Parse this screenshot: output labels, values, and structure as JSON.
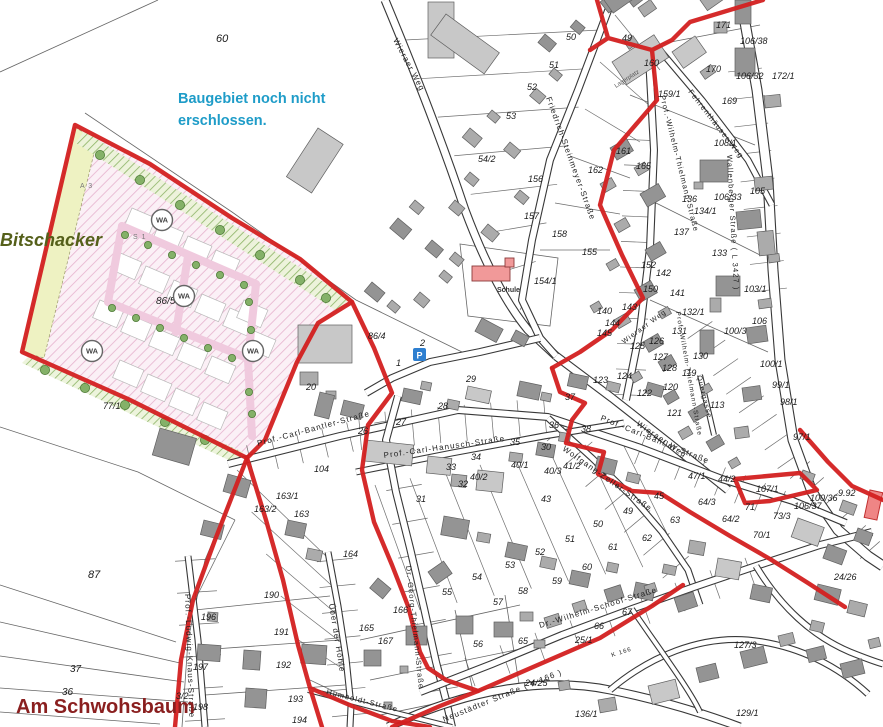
{
  "annotations": {
    "development_note_line1": "Baugebiet noch nicht",
    "development_note_line2": "erschlossen.",
    "area_name_west": "Bitschacker",
    "area_name_south": "Am Schwohsbaum"
  },
  "colors": {
    "note_blue": "#1e9cc8",
    "bitschacker_green": "#55601a",
    "schwohsbaum_red": "#8a1f1f",
    "boundary_red": "#d32020",
    "building_gray": "#ababab",
    "school_pink": "#f19999",
    "zone_hatch_pink": "#dd9fc4",
    "parking_blue": "#2e7fd0"
  },
  "map_labels": {
    "school": "Schule",
    "storage": "Lagerplatz",
    "parking": "P",
    "zone_wa": "WA"
  },
  "zone_labels": [
    {
      "t": "A 3",
      "x": 80,
      "y": 188
    },
    {
      "t": "S 1",
      "x": 133,
      "y": 239
    }
  ],
  "wa_circles": [
    [
      162,
      220
    ],
    [
      184,
      296
    ],
    [
      92,
      351
    ],
    [
      253,
      351
    ]
  ],
  "streets": [
    {
      "label": "Wieraer Weg",
      "x": 393,
      "y": 40,
      "r": 62,
      "s": 8
    },
    {
      "label": "Friedrich-Steinmeyer-Straße",
      "x": 546,
      "y": 98,
      "r": 70,
      "s": 8
    },
    {
      "label": "Prof.-Wilhelm-Thielmann-Straße",
      "x": 660,
      "y": 96,
      "r": 76,
      "s": 7.5
    },
    {
      "label": "Fehrenthäuser Weg",
      "x": 688,
      "y": 92,
      "r": 52,
      "s": 7.5
    },
    {
      "label": "Wallenberger Straße ( L 3427 )",
      "x": 727,
      "y": 155,
      "r": 87,
      "s": 7.5
    },
    {
      "label": "Wieraer Weg",
      "x": 636,
      "y": 425,
      "r": 34,
      "s": 8
    },
    {
      "label": "Prof.-Wilhelm-Thielmann-Straße",
      "x": 676,
      "y": 312,
      "r": 80,
      "s": 6.5
    },
    {
      "label": "Wieraer Weg",
      "x": 624,
      "y": 344,
      "r": -36,
      "s": 7
    },
    {
      "label": "Prof.-Carl-Bantler-Straße",
      "x": 258,
      "y": 446,
      "r": -15,
      "s": 8
    },
    {
      "label": "Prof.-Carl-Bantler-Straße",
      "x": 600,
      "y": 420,
      "r": 22,
      "s": 8
    },
    {
      "label": "Prof.-Carl-Hanusch-Straße",
      "x": 384,
      "y": 458,
      "r": -8,
      "s": 8
    },
    {
      "label": "Wolfgang-Zeller-Straße",
      "x": 562,
      "y": 450,
      "r": 35,
      "s": 8
    },
    {
      "label": "Quergasse",
      "x": 697,
      "y": 376,
      "r": 76,
      "s": 7
    },
    {
      "label": "Dr.-Georg-Thielmann-Straße",
      "x": 406,
      "y": 566,
      "r": 84,
      "s": 7.5
    },
    {
      "label": "Über der Höhle",
      "x": 329,
      "y": 604,
      "r": 81,
      "s": 8
    },
    {
      "label": "Prof.-Ludwig-Knaus-Straße",
      "x": 185,
      "y": 594,
      "r": 88,
      "s": 8
    },
    {
      "label": "Dr.-Wilhelm-Schoof-Straße",
      "x": 540,
      "y": 628,
      "r": -17,
      "s": 8
    },
    {
      "label": "Neustädter Straße ( K 166 )",
      "x": 444,
      "y": 722,
      "r": -22,
      "s": 8
    },
    {
      "label": "Humboldt-Straße",
      "x": 326,
      "y": 694,
      "r": 14,
      "s": 7.5
    },
    {
      "label": "K 166",
      "x": 612,
      "y": 657,
      "r": -18,
      "s": 6
    }
  ],
  "parcel_numbers": [
    {
      "t": "60",
      "x": 216,
      "y": 42,
      "s": 11
    },
    {
      "t": "87",
      "x": 88,
      "y": 578,
      "s": 11
    },
    {
      "t": "37",
      "x": 70,
      "y": 672,
      "s": 10
    },
    {
      "t": "36",
      "x": 62,
      "y": 695,
      "s": 10
    },
    {
      "t": "3/2",
      "x": 176,
      "y": 699
    },
    {
      "t": "77/1",
      "x": 103,
      "y": 409
    },
    {
      "t": "86/5",
      "x": 156,
      "y": 304,
      "s": 10
    },
    {
      "t": "86/4",
      "x": 368,
      "y": 339
    },
    {
      "t": "1",
      "x": 396,
      "y": 366
    },
    {
      "t": "2",
      "x": 420,
      "y": 346
    },
    {
      "t": "50",
      "x": 566,
      "y": 40
    },
    {
      "t": "51",
      "x": 549,
      "y": 68
    },
    {
      "t": "52",
      "x": 527,
      "y": 90
    },
    {
      "t": "53",
      "x": 506,
      "y": 119
    },
    {
      "t": "54/2",
      "x": 478,
      "y": 162
    },
    {
      "t": "49",
      "x": 622,
      "y": 41
    },
    {
      "t": "160",
      "x": 644,
      "y": 66
    },
    {
      "t": "159/1",
      "x": 658,
      "y": 97
    },
    {
      "t": "171",
      "x": 716,
      "y": 28
    },
    {
      "t": "170",
      "x": 706,
      "y": 72
    },
    {
      "t": "169",
      "x": 722,
      "y": 104
    },
    {
      "t": "106/38",
      "x": 740,
      "y": 44
    },
    {
      "t": "106/32",
      "x": 736,
      "y": 79
    },
    {
      "t": "172/1",
      "x": 772,
      "y": 79
    },
    {
      "t": "108/1",
      "x": 714,
      "y": 146
    },
    {
      "t": "105",
      "x": 750,
      "y": 194
    },
    {
      "t": "106/33",
      "x": 714,
      "y": 200
    },
    {
      "t": "134/1",
      "x": 694,
      "y": 214
    },
    {
      "t": "133",
      "x": 712,
      "y": 256
    },
    {
      "t": "103/1",
      "x": 744,
      "y": 292
    },
    {
      "t": "106",
      "x": 752,
      "y": 324
    },
    {
      "t": "100/3",
      "x": 724,
      "y": 334
    },
    {
      "t": "161",
      "x": 616,
      "y": 154
    },
    {
      "t": "162",
      "x": 588,
      "y": 173
    },
    {
      "t": "165",
      "x": 636,
      "y": 169
    },
    {
      "t": "136",
      "x": 682,
      "y": 202
    },
    {
      "t": "137",
      "x": 674,
      "y": 235
    },
    {
      "t": "156",
      "x": 528,
      "y": 182
    },
    {
      "t": "157",
      "x": 524,
      "y": 219
    },
    {
      "t": "158",
      "x": 552,
      "y": 237
    },
    {
      "t": "155",
      "x": 582,
      "y": 255
    },
    {
      "t": "154/1",
      "x": 534,
      "y": 284
    },
    {
      "t": "150",
      "x": 643,
      "y": 292
    },
    {
      "t": "152",
      "x": 641,
      "y": 268
    },
    {
      "t": "142",
      "x": 656,
      "y": 276
    },
    {
      "t": "141",
      "x": 670,
      "y": 296
    },
    {
      "t": "143",
      "x": 622,
      "y": 310
    },
    {
      "t": "140",
      "x": 597,
      "y": 314
    },
    {
      "t": "144",
      "x": 605,
      "y": 326
    },
    {
      "t": "145",
      "x": 597,
      "y": 336
    },
    {
      "t": "132/1",
      "x": 682,
      "y": 315
    },
    {
      "t": "131",
      "x": 672,
      "y": 334
    },
    {
      "t": "130",
      "x": 693,
      "y": 359
    },
    {
      "t": "125",
      "x": 630,
      "y": 349
    },
    {
      "t": "126",
      "x": 649,
      "y": 344
    },
    {
      "t": "127",
      "x": 653,
      "y": 360
    },
    {
      "t": "128",
      "x": 662,
      "y": 371
    },
    {
      "t": "119",
      "x": 682,
      "y": 376
    },
    {
      "t": "120",
      "x": 663,
      "y": 390
    },
    {
      "t": "121",
      "x": 667,
      "y": 416
    },
    {
      "t": "122",
      "x": 637,
      "y": 396
    },
    {
      "t": "123",
      "x": 593,
      "y": 383
    },
    {
      "t": "124",
      "x": 617,
      "y": 379
    },
    {
      "t": "100/1",
      "x": 760,
      "y": 367
    },
    {
      "t": "99/1",
      "x": 772,
      "y": 388
    },
    {
      "t": "98/1",
      "x": 780,
      "y": 405
    },
    {
      "t": "97/1",
      "x": 793,
      "y": 440
    },
    {
      "t": "113",
      "x": 710,
      "y": 408
    },
    {
      "t": "20",
      "x": 306,
      "y": 390
    },
    {
      "t": "26",
      "x": 358,
      "y": 434
    },
    {
      "t": "27",
      "x": 396,
      "y": 425
    },
    {
      "t": "28",
      "x": 438,
      "y": 409
    },
    {
      "t": "29",
      "x": 466,
      "y": 382
    },
    {
      "t": "30",
      "x": 541,
      "y": 450
    },
    {
      "t": "31",
      "x": 416,
      "y": 502
    },
    {
      "t": "32",
      "x": 458,
      "y": 487
    },
    {
      "t": "33",
      "x": 446,
      "y": 470
    },
    {
      "t": "34",
      "x": 471,
      "y": 460
    },
    {
      "t": "35",
      "x": 510,
      "y": 445
    },
    {
      "t": "40/1",
      "x": 511,
      "y": 468
    },
    {
      "t": "40/2",
      "x": 470,
      "y": 480
    },
    {
      "t": "40/3",
      "x": 544,
      "y": 474
    },
    {
      "t": "41/2",
      "x": 563,
      "y": 469
    },
    {
      "t": "43",
      "x": 541,
      "y": 502
    },
    {
      "t": "37",
      "x": 565,
      "y": 400
    },
    {
      "t": "36",
      "x": 549,
      "y": 428
    },
    {
      "t": "38",
      "x": 581,
      "y": 432
    },
    {
      "t": "104",
      "x": 314,
      "y": 472
    },
    {
      "t": "163/1",
      "x": 276,
      "y": 499
    },
    {
      "t": "163/2",
      "x": 254,
      "y": 512
    },
    {
      "t": "163",
      "x": 294,
      "y": 517
    },
    {
      "t": "44/2",
      "x": 718,
      "y": 482
    },
    {
      "t": "45",
      "x": 654,
      "y": 499
    },
    {
      "t": "47/1",
      "x": 688,
      "y": 479
    },
    {
      "t": "107/1",
      "x": 756,
      "y": 492
    },
    {
      "t": "64/3",
      "x": 698,
      "y": 505
    },
    {
      "t": "64/2",
      "x": 722,
      "y": 522
    },
    {
      "t": "63",
      "x": 670,
      "y": 523
    },
    {
      "t": "62",
      "x": 642,
      "y": 541
    },
    {
      "t": "61",
      "x": 608,
      "y": 550
    },
    {
      "t": "60",
      "x": 582,
      "y": 570
    },
    {
      "t": "59",
      "x": 552,
      "y": 584
    },
    {
      "t": "58",
      "x": 518,
      "y": 594
    },
    {
      "t": "57",
      "x": 493,
      "y": 605
    },
    {
      "t": "56",
      "x": 473,
      "y": 647
    },
    {
      "t": "55",
      "x": 442,
      "y": 595
    },
    {
      "t": "54",
      "x": 472,
      "y": 580
    },
    {
      "t": "53",
      "x": 505,
      "y": 568
    },
    {
      "t": "52",
      "x": 535,
      "y": 555
    },
    {
      "t": "51",
      "x": 565,
      "y": 542
    },
    {
      "t": "50",
      "x": 593,
      "y": 527
    },
    {
      "t": "49",
      "x": 623,
      "y": 514
    },
    {
      "t": "73/3",
      "x": 773,
      "y": 519
    },
    {
      "t": "71",
      "x": 745,
      "y": 510
    },
    {
      "t": "70/1",
      "x": 753,
      "y": 538
    },
    {
      "t": "106/37",
      "x": 794,
      "y": 509
    },
    {
      "t": "100/36",
      "x": 810,
      "y": 501
    },
    {
      "t": "9.92",
      "x": 838,
      "y": 496
    },
    {
      "t": "24/26",
      "x": 834,
      "y": 580
    },
    {
      "t": "65",
      "x": 518,
      "y": 644
    },
    {
      "t": "66",
      "x": 594,
      "y": 629
    },
    {
      "t": "67",
      "x": 622,
      "y": 615
    },
    {
      "t": "25/1",
      "x": 575,
      "y": 643
    },
    {
      "t": "24/25",
      "x": 525,
      "y": 686
    },
    {
      "t": "136/1",
      "x": 575,
      "y": 717
    },
    {
      "t": "127/3",
      "x": 734,
      "y": 648
    },
    {
      "t": "129/1",
      "x": 736,
      "y": 716
    },
    {
      "t": "196",
      "x": 201,
      "y": 620
    },
    {
      "t": "197",
      "x": 193,
      "y": 670
    },
    {
      "t": "198",
      "x": 193,
      "y": 710
    },
    {
      "t": "190",
      "x": 264,
      "y": 598
    },
    {
      "t": "191",
      "x": 274,
      "y": 635
    },
    {
      "t": "192",
      "x": 276,
      "y": 668
    },
    {
      "t": "193",
      "x": 288,
      "y": 702
    },
    {
      "t": "194",
      "x": 292,
      "y": 723
    },
    {
      "t": "164",
      "x": 343,
      "y": 557
    },
    {
      "t": "166",
      "x": 393,
      "y": 613
    },
    {
      "t": "165",
      "x": 359,
      "y": 631
    },
    {
      "t": "167",
      "x": 378,
      "y": 644
    }
  ]
}
